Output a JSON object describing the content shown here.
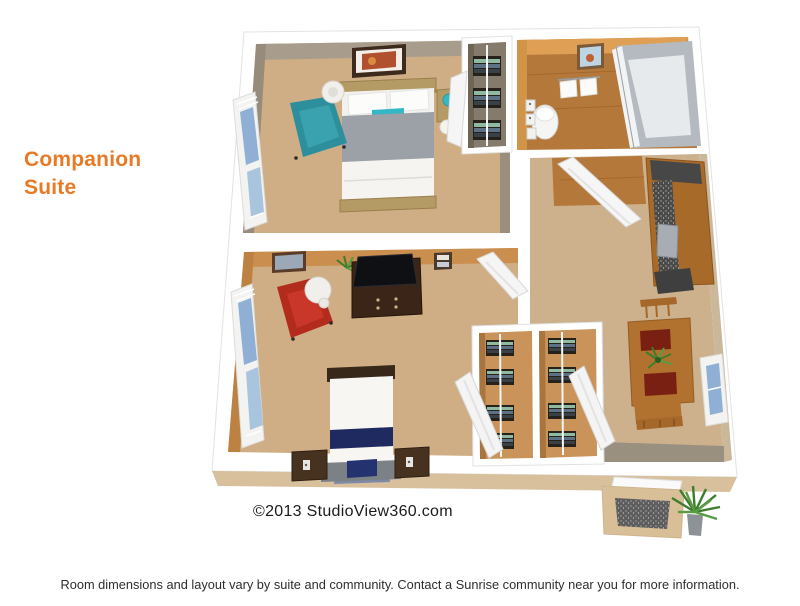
{
  "title": {
    "line1": "Companion",
    "line2": "Suite",
    "color": "#E87A26"
  },
  "watermark": {
    "text": "©2013 StudioView360.com"
  },
  "footer": {
    "text": "Room dimensions and layout vary by suite and community. Contact a Sunrise community near you for more information."
  },
  "floor_plan": {
    "type": "3d-isometric-floor-plan",
    "areas": [
      "bedroom-1",
      "bedroom-2",
      "bathroom",
      "bedroom-closet",
      "wardrobe-closets",
      "kitchenette",
      "dining-area",
      "entry-foyer",
      "porch"
    ],
    "colors": {
      "accent_orange": "#E87A26",
      "floor_tan": "#cfae85",
      "wall_taupe": "#a89d8c",
      "wall_orange": "#ca8e4f",
      "bathroom_wall": "#dfa055",
      "wood_floor": "#b5783b",
      "teal_chair": "#2e8f9c",
      "red_chair": "#b32b1d",
      "navy_accent": "#1e2a60",
      "wood_furniture": "#b0722e",
      "counter_dark": "#4a4a48",
      "doormat_gray": "#5d5d5d",
      "plant_green": "#3e7d2c"
    }
  }
}
